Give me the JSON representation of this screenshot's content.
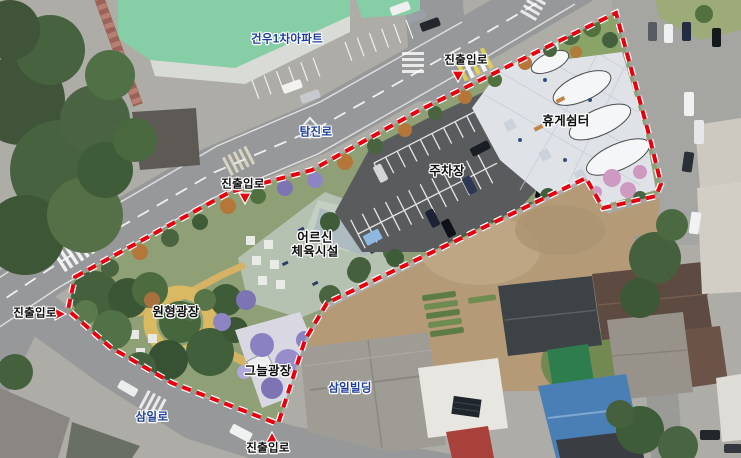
{
  "colors": {
    "boundary_red": "#e8000f",
    "label_plan_black": "#0d0d0d",
    "label_existing_blue": "#1c3f9e",
    "road_gray": "#96989a",
    "park_green": "#8fa076",
    "parking_asphalt": "#595b5d",
    "rest_plaza_light": "#dfe3e8",
    "senior_plaza_sage": "#b5c2b2",
    "path_tan": "#d9ba62",
    "apartment_roof_mint": "#86cfa6",
    "dirt_lot_tan": "#b49a77",
    "blue_roof": "#4a7fb5"
  },
  "labels": [
    {
      "id": "gunwoo-apartment",
      "text": "건우1차아파트",
      "category": "existing"
    },
    {
      "id": "access-road-top",
      "text": "진출입로",
      "category": "plan"
    },
    {
      "id": "rest-shelter",
      "text": "휴게쉼터",
      "category": "plan"
    },
    {
      "id": "tamjin-ro",
      "text": "탐진로",
      "category": "existing"
    },
    {
      "id": "parking-lot",
      "text": "주차장",
      "category": "plan"
    },
    {
      "id": "access-road-mid",
      "text": "진출입로",
      "category": "plan"
    },
    {
      "id": "senior-fitness-area",
      "text": "어르신\n체육시설",
      "category": "plan"
    },
    {
      "id": "circular-plaza",
      "text": "원형광장",
      "category": "plan"
    },
    {
      "id": "access-road-left",
      "text": "진출입로",
      "category": "plan"
    },
    {
      "id": "shade-plaza",
      "text": "그늘광장",
      "category": "plan"
    },
    {
      "id": "samil-building",
      "text": "삼일빌딩",
      "category": "existing"
    },
    {
      "id": "samil-ro",
      "text": "삼일로",
      "category": "existing"
    },
    {
      "id": "access-road-bottom",
      "text": "진출입로",
      "category": "plan"
    }
  ],
  "markers": [
    {
      "name": "access-arrow-top",
      "direction": "down"
    },
    {
      "name": "access-arrow-mid",
      "direction": "down"
    },
    {
      "name": "access-arrow-left",
      "direction": "right"
    },
    {
      "name": "access-arrow-bottom",
      "direction": "up"
    }
  ]
}
